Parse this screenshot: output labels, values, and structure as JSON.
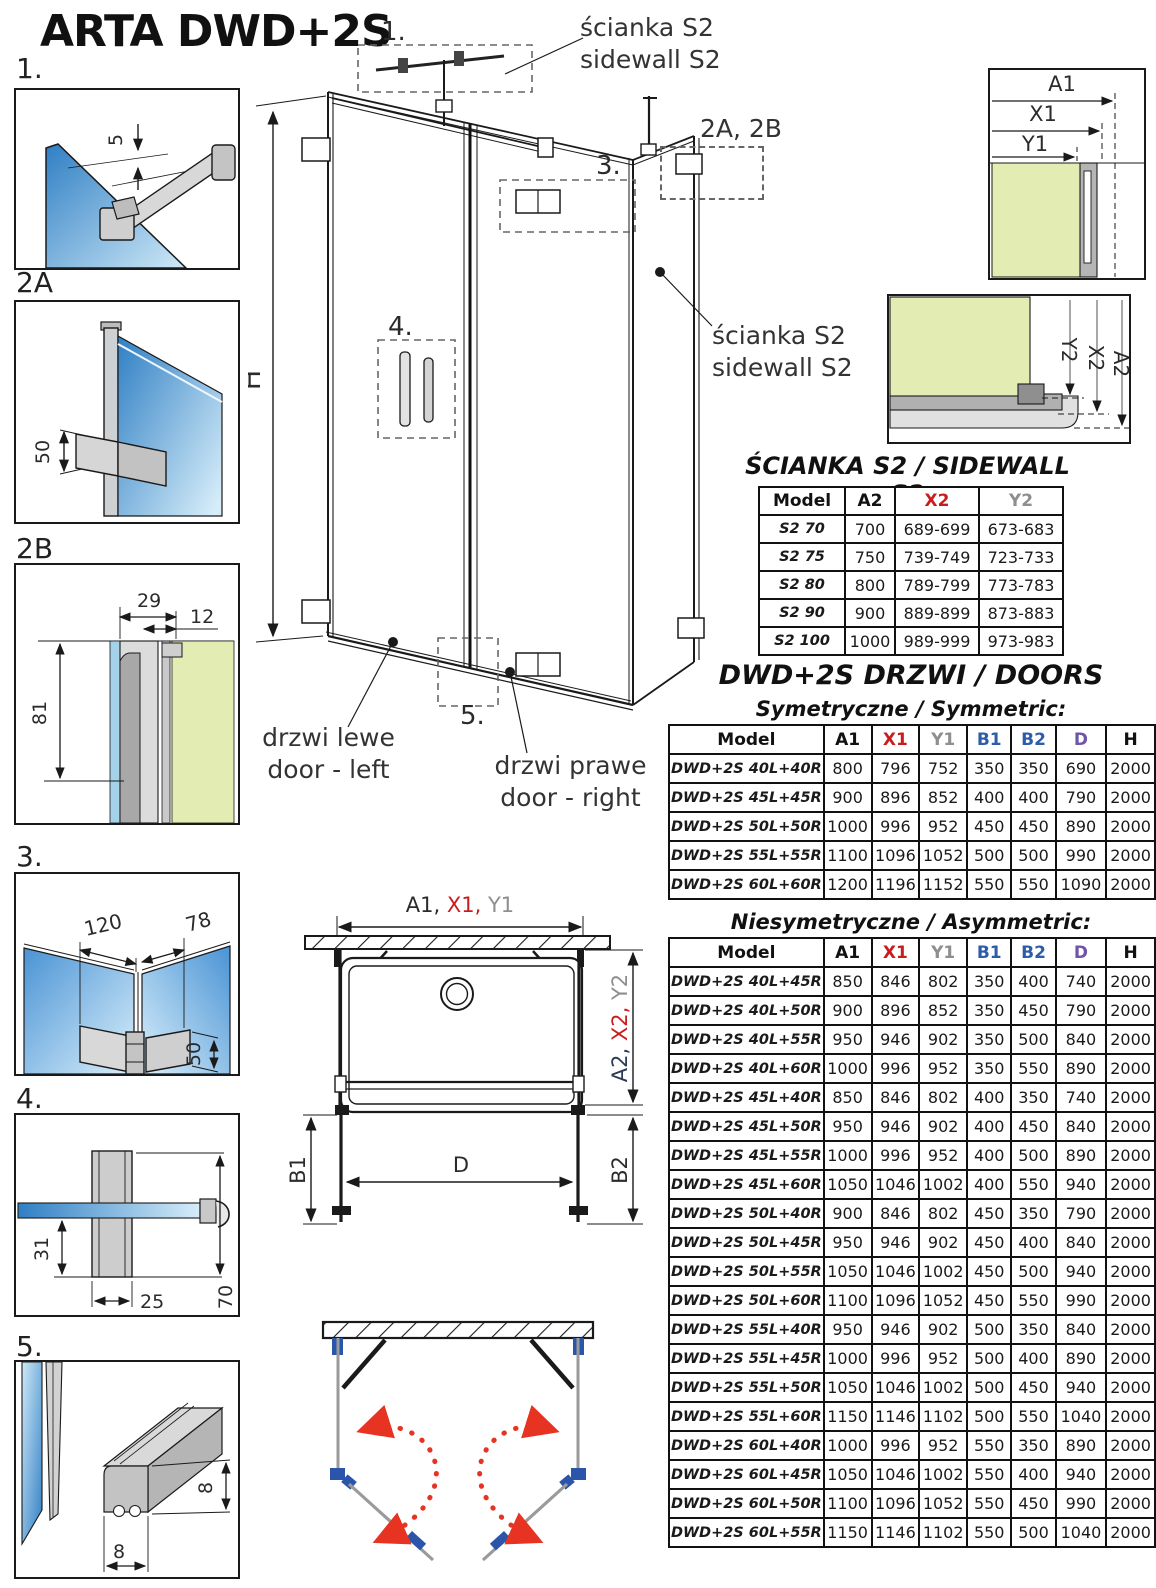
{
  "page_title": "ARTA DWD+2S",
  "colors": {
    "x_dim_red": "#c91d1d",
    "y_dim_gray": "#8e8e8e",
    "b_dim_blue": "#2d5da8",
    "d_dim_purple": "#6f54a8",
    "glass_blue": "#3f8fd2",
    "wall_green": "#e3ecb2",
    "profile_gray": "#c6c6c6",
    "swing_arrow_red": "#e63322",
    "hinge_blue": "#2b55a8"
  },
  "details": {
    "d1": {
      "label": "1.",
      "dim": "5"
    },
    "d2a": {
      "label": "2A",
      "dim": "50"
    },
    "d2b": {
      "label": "2B",
      "dim_width": "29",
      "dim_offset": "12",
      "dim_height": "81"
    },
    "d3": {
      "label": "3.",
      "dim_left": "120",
      "dim_right": "78",
      "dim_hinge": "50"
    },
    "d4": {
      "label": "4.",
      "dim_glass": "31",
      "dim_width": "25",
      "dim_height": "70"
    },
    "d5": {
      "label": "5.",
      "dim_side": "8",
      "dim_bottom": "8"
    }
  },
  "main_drawing": {
    "callout_1": "1.",
    "callout_2ab": "2A, 2B",
    "callout_3": "3.",
    "callout_4": "4.",
    "callout_5": "5.",
    "dim_height": "H",
    "sidewall_top_pl": "ścianka S2",
    "sidewall_top_en": "sidewall S2",
    "sidewall_right_pl": "ścianka S2",
    "sidewall_right_en": "sidewall S2",
    "door_left_pl": "drzwi lewe",
    "door_left_en": "door - left",
    "door_right_pl": "drzwi prawe",
    "door_right_en": "door - right"
  },
  "corner_detail_door": {
    "a1": "A1",
    "x1": "X1",
    "y1": "Y1"
  },
  "corner_detail_sidewall": {
    "y2": "Y2",
    "x2": "X2",
    "a2": "A2"
  },
  "plan_view": {
    "top_a1": "A1, ",
    "top_x1": "X1, ",
    "top_y1": "Y1",
    "right_a2": "A2, ",
    "right_x2": "X2, ",
    "right_y2": "Y2",
    "b1": "B1",
    "b2": "B2",
    "d": "D"
  },
  "sidewall_table": {
    "title": "ŚCIANKA S2 / SIDEWALL S2",
    "headers": [
      "Model",
      "A2",
      "X2",
      "Y2"
    ],
    "rows": [
      [
        "S2 70",
        "700",
        "689-699",
        "673-683"
      ],
      [
        "S2 75",
        "750",
        "739-749",
        "723-733"
      ],
      [
        "S2 80",
        "800",
        "789-799",
        "773-783"
      ],
      [
        "S2 90",
        "900",
        "889-899",
        "873-883"
      ],
      [
        "S2 100",
        "1000",
        "989-999",
        "973-983"
      ]
    ]
  },
  "doors": {
    "title": "DWD+2S DRZWI / DOORS",
    "symmetric": {
      "subtitle": "Symetryczne / Symmetric:",
      "headers": [
        "Model",
        "A1",
        "X1",
        "Y1",
        "B1",
        "B2",
        "D",
        "H"
      ],
      "rows": [
        [
          "DWD+2S 40L+40R",
          "800",
          "796",
          "752",
          "350",
          "350",
          "690",
          "2000"
        ],
        [
          "DWD+2S 45L+45R",
          "900",
          "896",
          "852",
          "400",
          "400",
          "790",
          "2000"
        ],
        [
          "DWD+2S 50L+50R",
          "1000",
          "996",
          "952",
          "450",
          "450",
          "890",
          "2000"
        ],
        [
          "DWD+2S 55L+55R",
          "1100",
          "1096",
          "1052",
          "500",
          "500",
          "990",
          "2000"
        ],
        [
          "DWD+2S 60L+60R",
          "1200",
          "1196",
          "1152",
          "550",
          "550",
          "1090",
          "2000"
        ]
      ]
    },
    "asymmetric": {
      "subtitle": "Niesymetryczne / Asymmetric:",
      "headers": [
        "Model",
        "A1",
        "X1",
        "Y1",
        "B1",
        "B2",
        "D",
        "H"
      ],
      "rows": [
        [
          "DWD+2S 40L+45R",
          "850",
          "846",
          "802",
          "350",
          "400",
          "740",
          "2000"
        ],
        [
          "DWD+2S 40L+50R",
          "900",
          "896",
          "852",
          "350",
          "450",
          "790",
          "2000"
        ],
        [
          "DWD+2S 40L+55R",
          "950",
          "946",
          "902",
          "350",
          "500",
          "840",
          "2000"
        ],
        [
          "DWD+2S 40L+60R",
          "1000",
          "996",
          "952",
          "350",
          "550",
          "890",
          "2000"
        ],
        [
          "DWD+2S 45L+40R",
          "850",
          "846",
          "802",
          "400",
          "350",
          "740",
          "2000"
        ],
        [
          "DWD+2S 45L+50R",
          "950",
          "946",
          "902",
          "400",
          "450",
          "840",
          "2000"
        ],
        [
          "DWD+2S 45L+55R",
          "1000",
          "996",
          "952",
          "400",
          "500",
          "890",
          "2000"
        ],
        [
          "DWD+2S 45L+60R",
          "1050",
          "1046",
          "1002",
          "400",
          "550",
          "940",
          "2000"
        ],
        [
          "DWD+2S 50L+40R",
          "900",
          "846",
          "802",
          "450",
          "350",
          "790",
          "2000"
        ],
        [
          "DWD+2S 50L+45R",
          "950",
          "946",
          "902",
          "450",
          "400",
          "840",
          "2000"
        ],
        [
          "DWD+2S 50L+55R",
          "1050",
          "1046",
          "1002",
          "450",
          "500",
          "940",
          "2000"
        ],
        [
          "DWD+2S 50L+60R",
          "1100",
          "1096",
          "1052",
          "450",
          "550",
          "990",
          "2000"
        ],
        [
          "DWD+2S 55L+40R",
          "950",
          "946",
          "902",
          "500",
          "350",
          "840",
          "2000"
        ],
        [
          "DWD+2S 55L+45R",
          "1000",
          "996",
          "952",
          "500",
          "400",
          "890",
          "2000"
        ],
        [
          "DWD+2S 55L+50R",
          "1050",
          "1046",
          "1002",
          "500",
          "450",
          "940",
          "2000"
        ],
        [
          "DWD+2S 55L+60R",
          "1150",
          "1146",
          "1102",
          "500",
          "550",
          "1040",
          "2000"
        ],
        [
          "DWD+2S 60L+40R",
          "1000",
          "996",
          "952",
          "550",
          "350",
          "890",
          "2000"
        ],
        [
          "DWD+2S 60L+45R",
          "1050",
          "1046",
          "1002",
          "550",
          "400",
          "940",
          "2000"
        ],
        [
          "DWD+2S 60L+50R",
          "1100",
          "1096",
          "1052",
          "550",
          "450",
          "990",
          "2000"
        ],
        [
          "DWD+2S 60L+55R",
          "1150",
          "1146",
          "1102",
          "550",
          "500",
          "1040",
          "2000"
        ]
      ]
    }
  }
}
